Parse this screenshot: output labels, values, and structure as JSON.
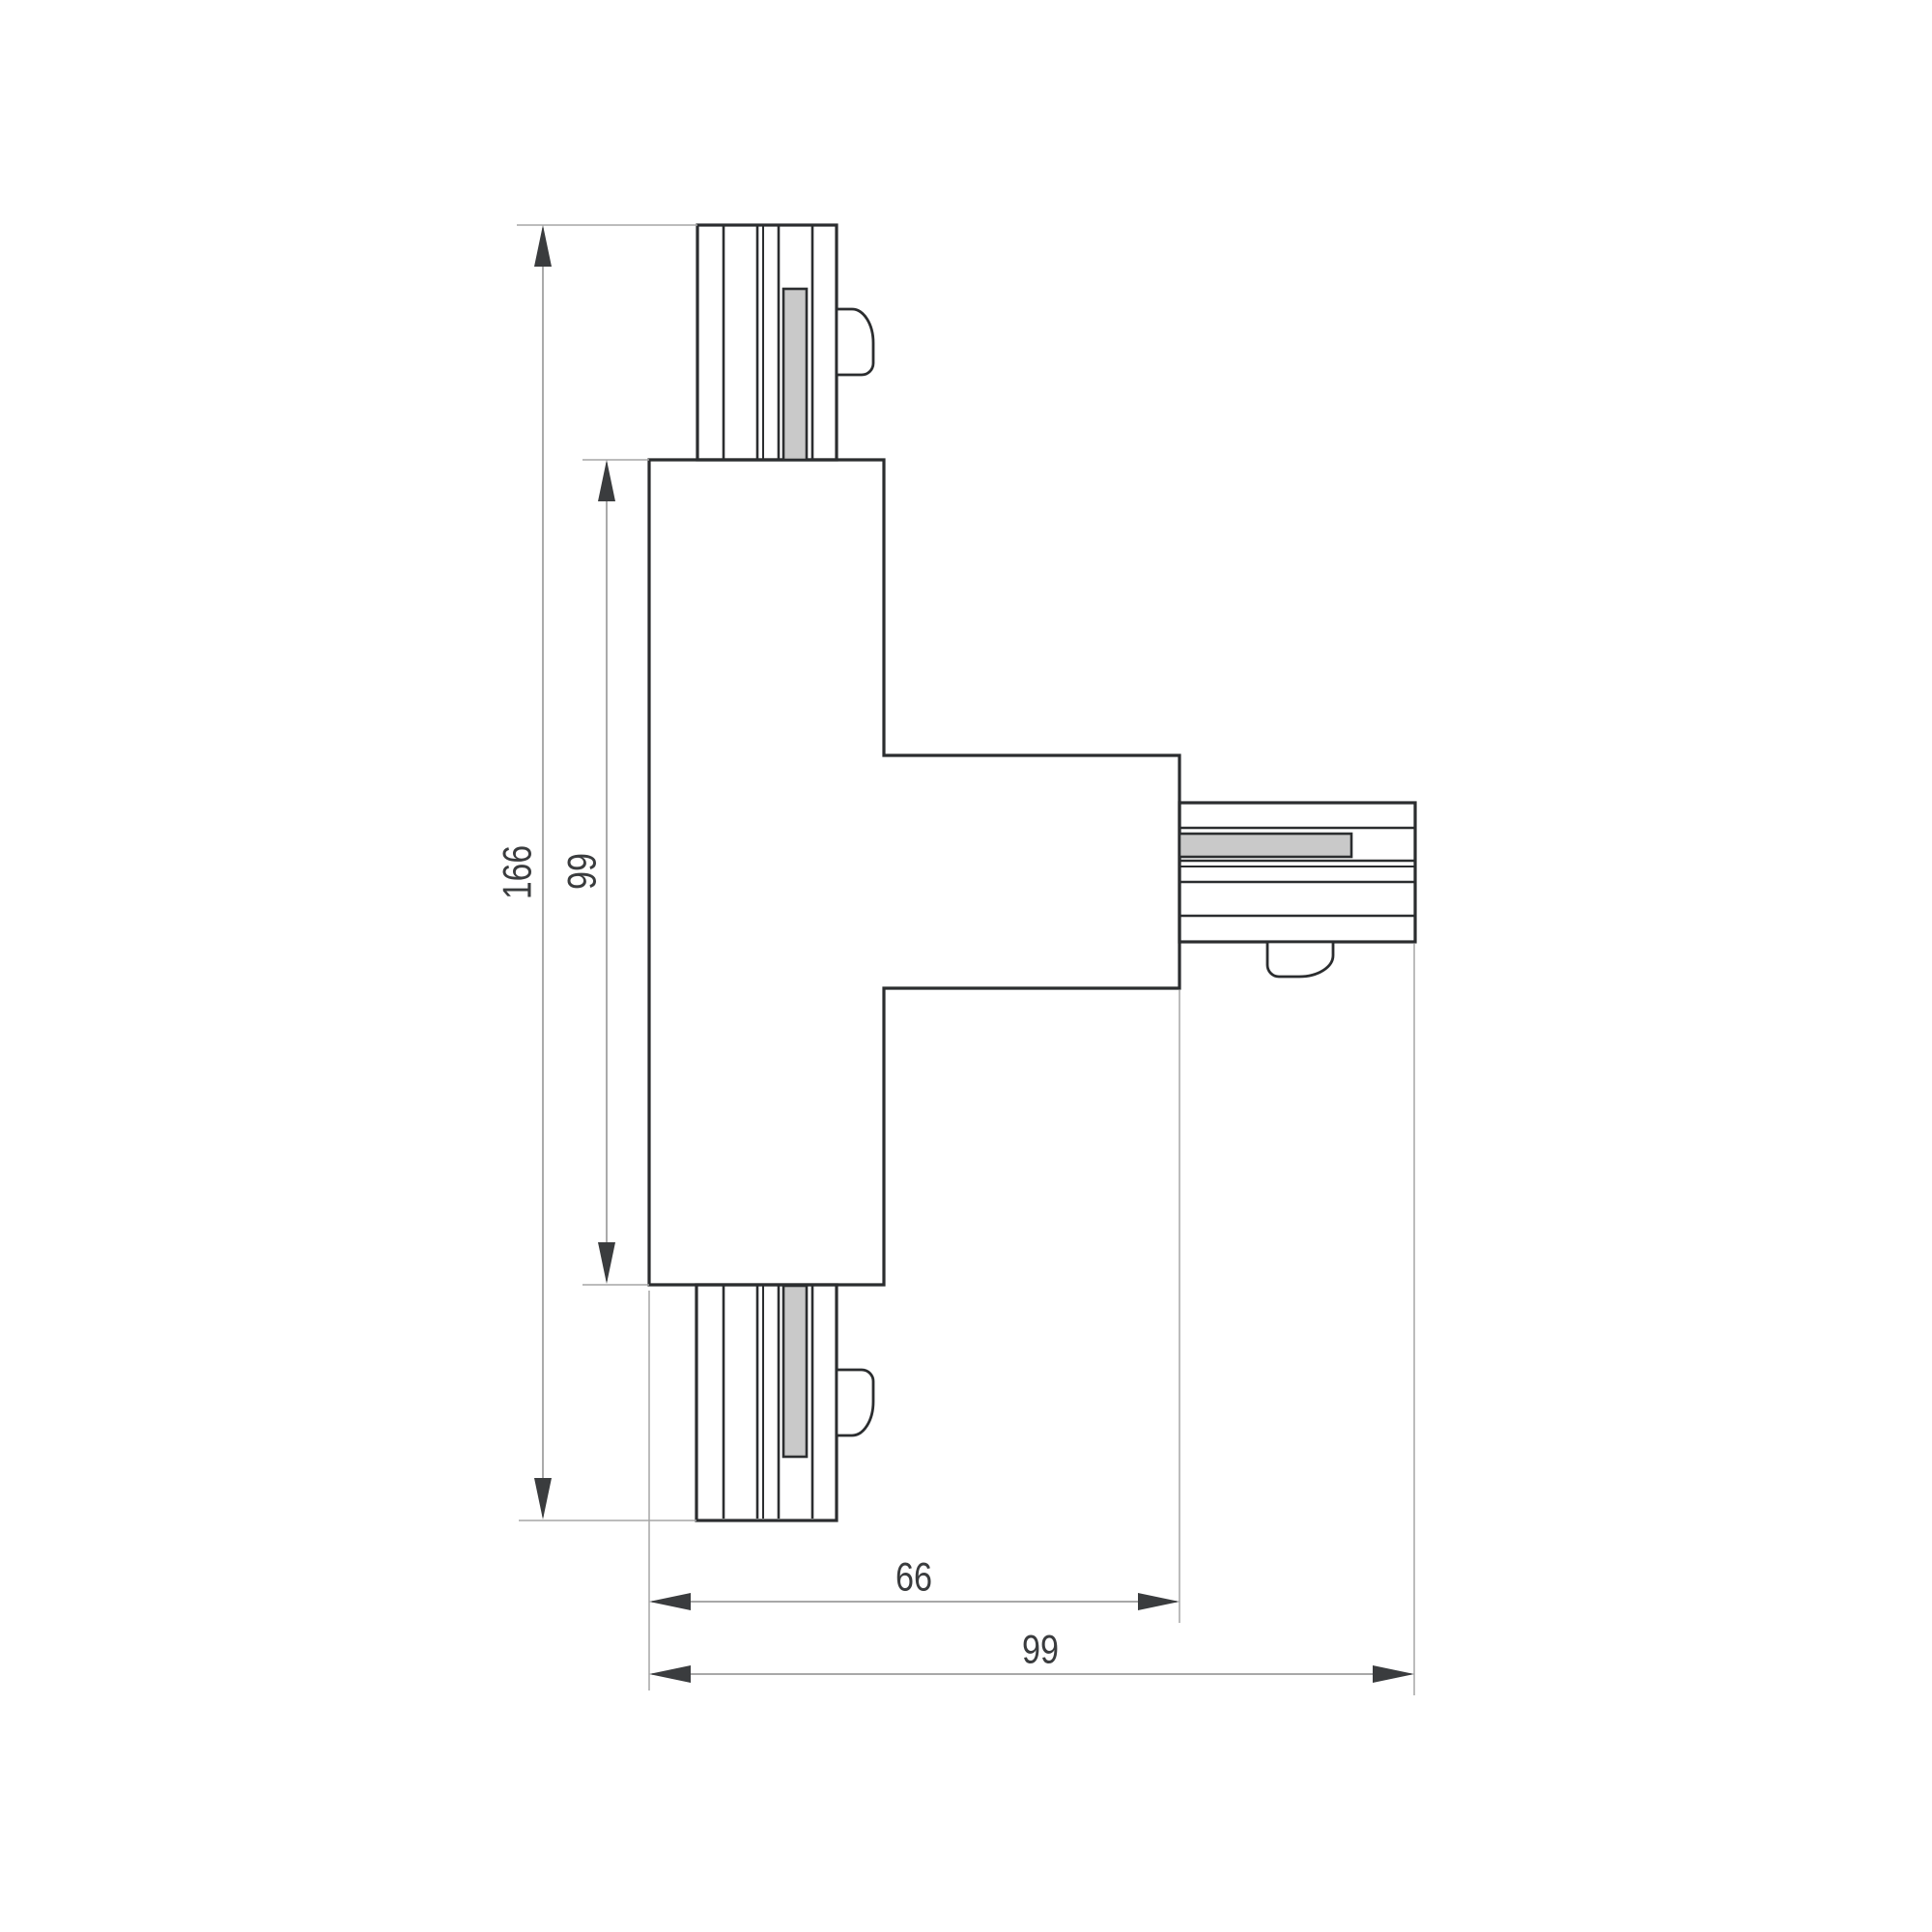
{
  "drawing": {
    "title": "t-connector-dimensioned-drawing",
    "dimensions": {
      "overall_height": "166",
      "body_height": "99",
      "body_to_arm_end_width": "66",
      "overall_width": "99"
    },
    "colors": {
      "background": "#ffffff",
      "outline": "#2b2d2f",
      "dimension_line": "#9b9b9b",
      "arrow_and_text": "#3a3c3e",
      "contact_strip_fill": "#c9c9c9"
    }
  }
}
